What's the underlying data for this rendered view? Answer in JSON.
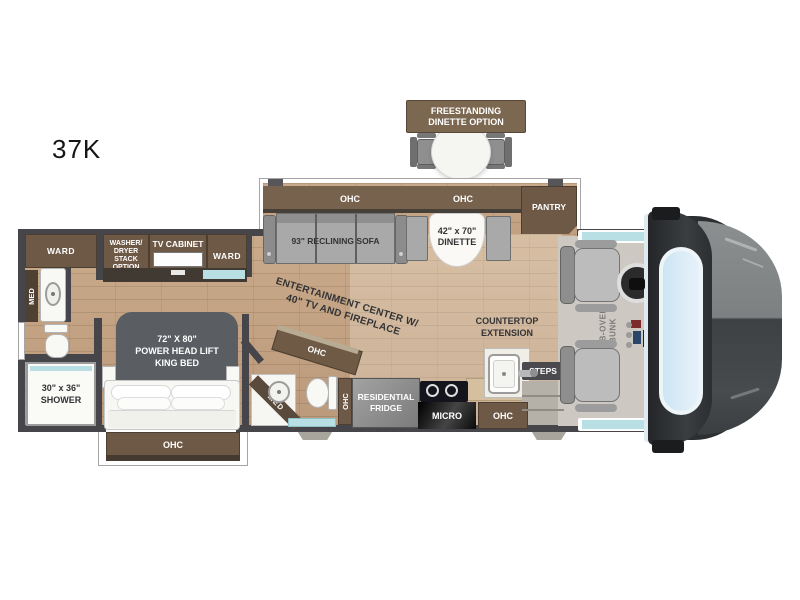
{
  "plan_label": "37K",
  "colors": {
    "floor_wood": "#c2a183",
    "cabinet_brown": "#6e5947",
    "cabinet_dark": "#45392e",
    "wall": "#46464a",
    "furniture_gray": "#a9a9a9",
    "window_teal": "#b8e0e4",
    "bed_headboard": "#5a5e63",
    "front_cap_dark": "#2c2f32",
    "windshield_blue": "#d5e9f5"
  },
  "labels": {
    "ohc": "OHC",
    "pantry": "PANTRY",
    "ward": "WARD",
    "med": "MED",
    "micro": "MICRO",
    "steps": "STEPS",
    "tv_cabinet": "TV CABINET",
    "sofa": "93\" RECLINING SOFA"
  },
  "freestanding_dinette": {
    "line1": "FREESTANDING",
    "line2": "DINETTE OPTION"
  },
  "dinette": {
    "line1": "42\" x 70\"",
    "line2": "DINETTE"
  },
  "washer_dryer": {
    "line1": "WASHER/",
    "line2": "DRYER",
    "line3": "STACK",
    "line4": "OPTION"
  },
  "shower": {
    "line1": "30\" x 36\"",
    "line2": "SHOWER"
  },
  "king_bed": {
    "line1": "72\" X 80\"",
    "line2": "POWER HEAD LIFT",
    "line3": "KING BED"
  },
  "entertainment": {
    "line1": "ENTERTAINMENT CENTER W/",
    "line2": "40\" TV AND FIREPLACE"
  },
  "countertop": {
    "line1": "COUNTERTOP",
    "line2": "EXTENSION"
  },
  "fridge": {
    "line1": "RESIDENTIAL",
    "line2": "FRIDGE"
  },
  "cab_over_bunk": {
    "line1": "CAB-OVER",
    "line2": "BUNK"
  }
}
